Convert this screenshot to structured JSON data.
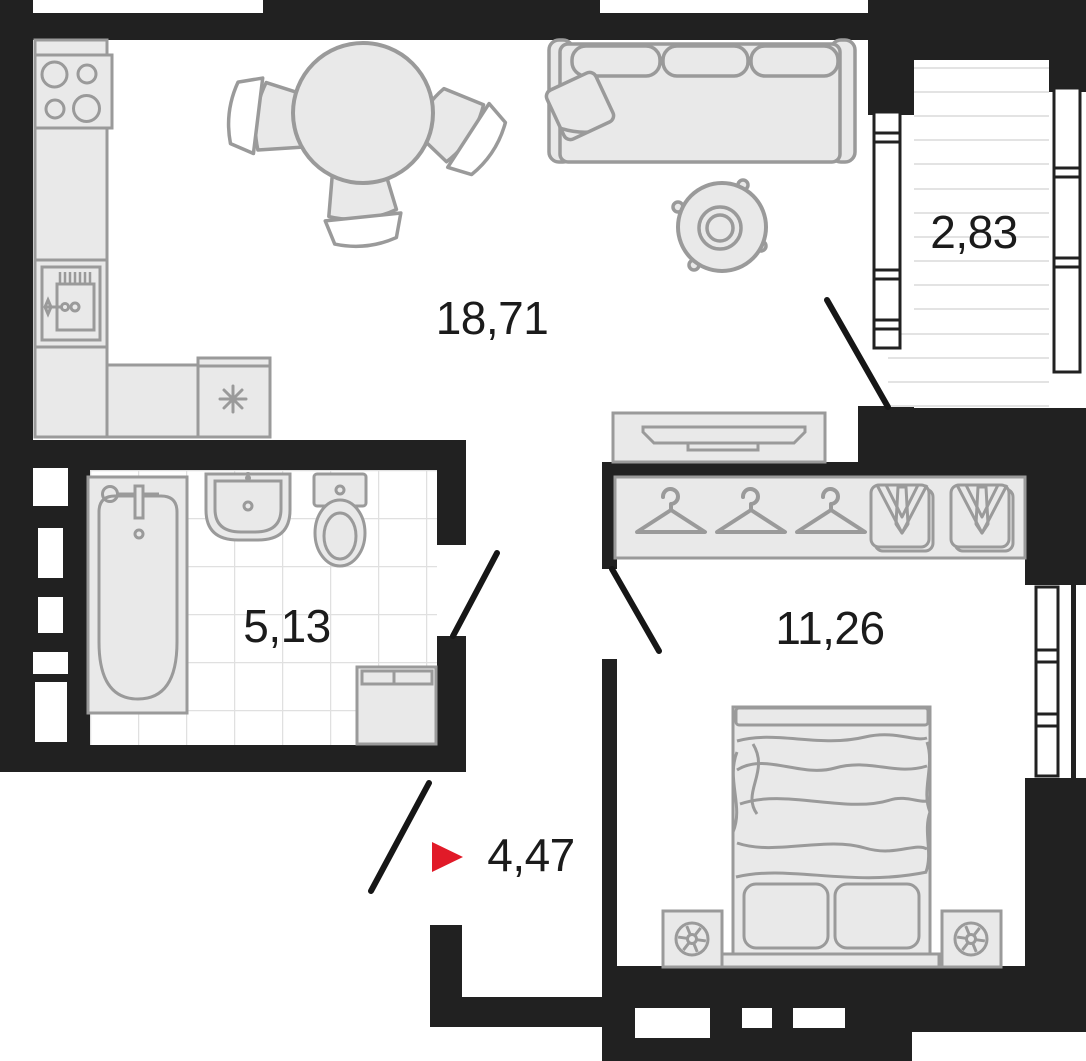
{
  "colors": {
    "wall": "#212121",
    "furniture_fill": "#e9e9e9",
    "furniture_stroke": "#9a9a9a",
    "tile_line": "#e0e0e0",
    "balcony_hatch": "#e3e3e3",
    "accent_red": "#e11a28",
    "label_text": "#1b1b1b"
  },
  "plan": {
    "title": "apartment floor plan",
    "rooms": [
      {
        "id": "living-kitchen",
        "area_label": "18,71"
      },
      {
        "id": "balcony",
        "area_label": "2,83"
      },
      {
        "id": "bathroom",
        "area_label": "5,13"
      },
      {
        "id": "bedroom",
        "area_label": "11,26"
      },
      {
        "id": "hallway",
        "area_label": "4,47"
      }
    ],
    "entrance": {
      "marker": "red-triangle-right",
      "at_room": "hallway"
    },
    "doors": [
      "balcony-door",
      "bathroom-door",
      "bedroom-door",
      "entrance-door"
    ],
    "windows": [
      "balcony-window-left",
      "balcony-window-right",
      "bedroom-window"
    ],
    "furniture_icons": [
      "stove-icon",
      "kitchen-cabinet-icon",
      "kitchen-sink-icon",
      "dishwasher-icon",
      "dining-table-icon",
      "dining-chair-icon",
      "sofa-icon",
      "pillow-icon",
      "coffee-table-icon",
      "tv-stand-icon",
      "wardrobe-icon",
      "hanger-icon",
      "suit-icon",
      "bed-icon",
      "nightstand-icon",
      "bathtub-icon",
      "washbasin-icon",
      "toilet-icon",
      "washing-machine-icon"
    ]
  }
}
